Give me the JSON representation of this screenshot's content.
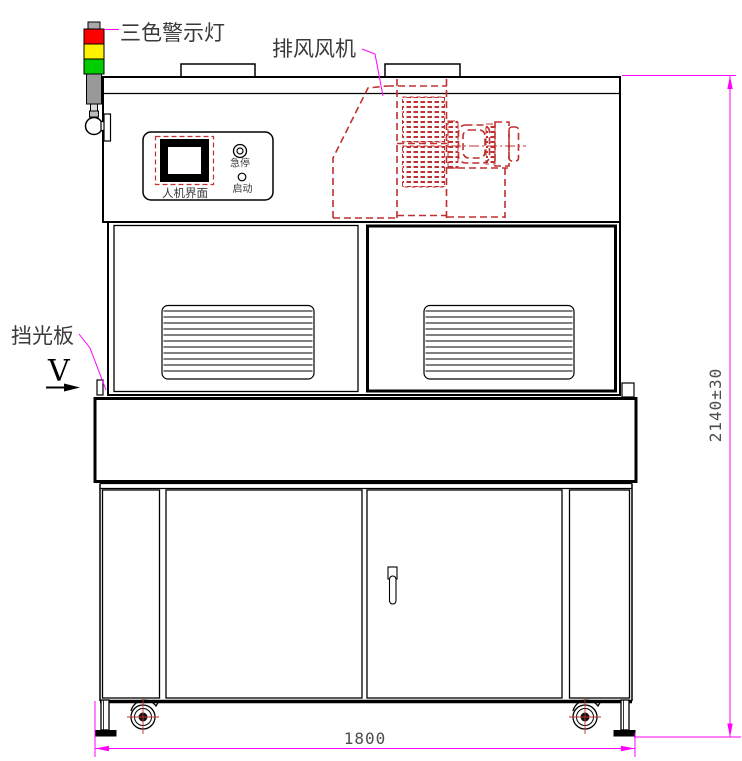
{
  "labels": {
    "warning_light": "三色警示灯",
    "exhaust_fan": "排风风机",
    "light_shield": "挡光板",
    "hmi": "人机界面",
    "estop": "急停",
    "start": "启动",
    "view": "V"
  },
  "dimensions": {
    "height": "2140±30",
    "width": "1800"
  },
  "colors": {
    "line": "#000000",
    "dimension_line": "#FF00FF",
    "hidden_part": "#C03030",
    "lamp_red": "#FF0000",
    "lamp_yellow": "#FFF200",
    "lamp_green": "#00CC00",
    "lamp_gray": "#999999",
    "lamp_cap_gray": "#AAAAAA"
  }
}
